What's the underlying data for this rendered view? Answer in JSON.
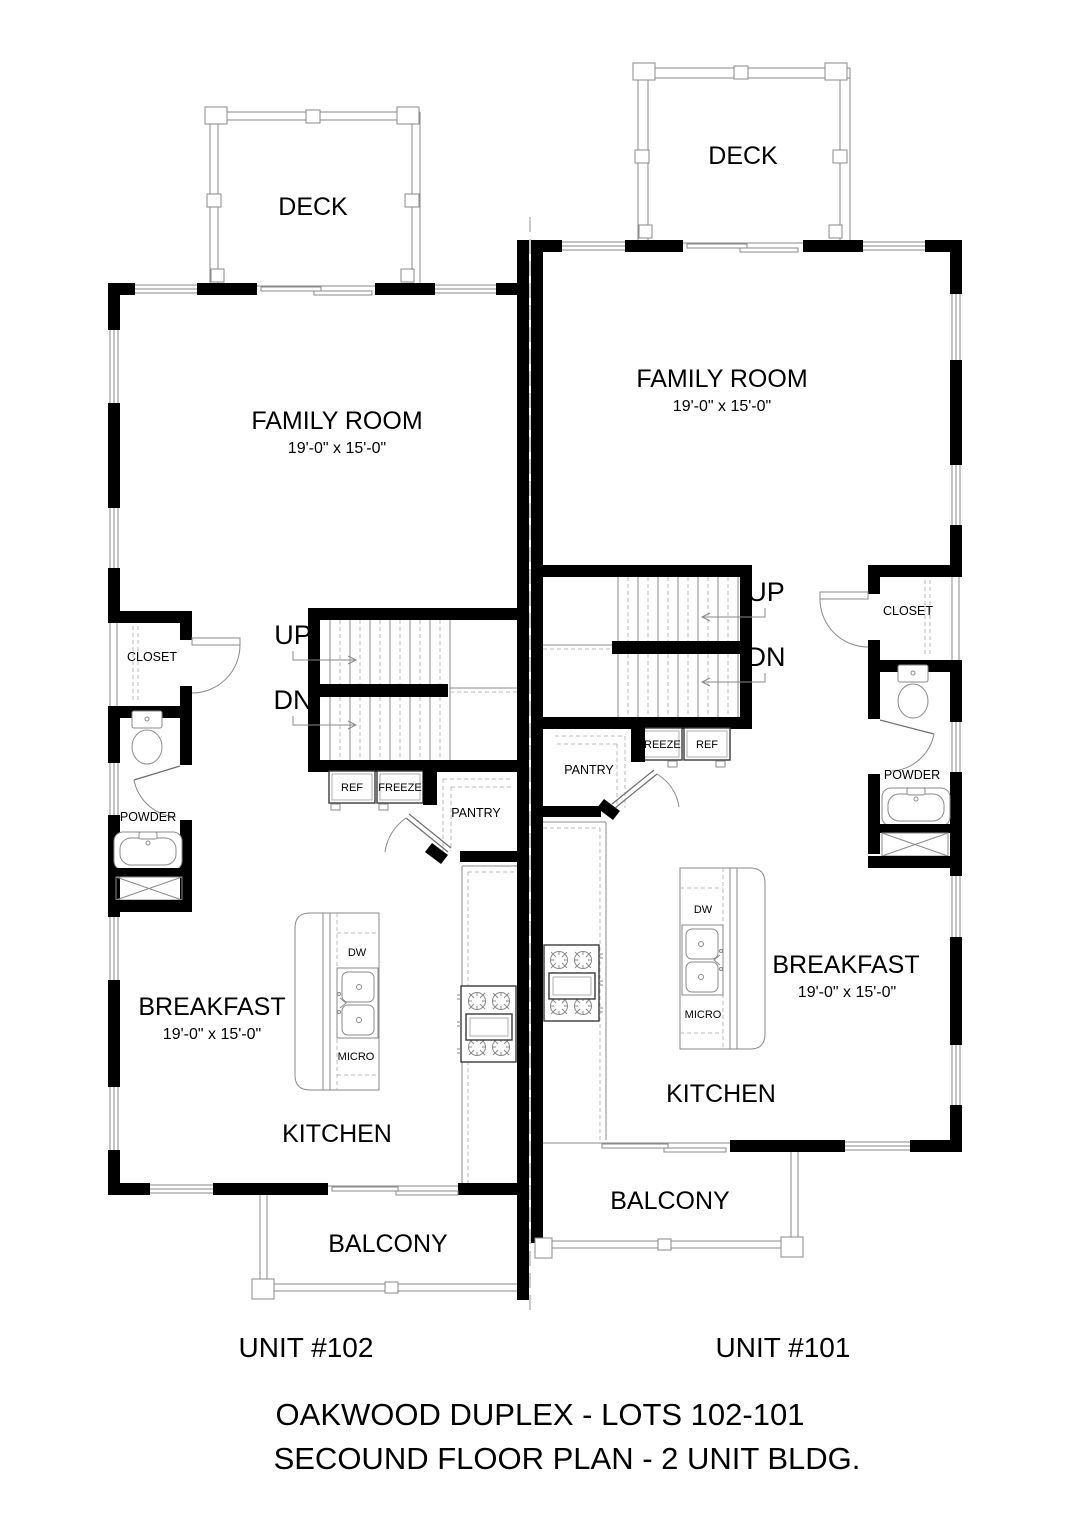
{
  "title": {
    "line1": "OAKWOOD DUPLEX - LOTS 102-101",
    "line2": "SECOUND FLOOR PLAN - 2 UNIT BLDG."
  },
  "unit_102": {
    "label": "UNIT #102",
    "deck": "DECK",
    "family_room": "FAMILY ROOM",
    "family_room_dims": "19'-0\" x 15'-0\"",
    "closet": "CLOSET",
    "powder": "POWDER",
    "up": "UP",
    "dn": "DN",
    "ref": "REF",
    "freeze": "FREEZE",
    "pantry": "PANTRY",
    "dw": "DW",
    "micro": "MICRO",
    "breakfast": "BREAKFAST",
    "breakfast_dims": "19'-0\" x 15'-0\"",
    "kitchen": "KITCHEN",
    "balcony": "BALCONY"
  },
  "unit_101": {
    "label": "UNIT #101",
    "deck": "DECK",
    "family_room": "FAMILY ROOM",
    "family_room_dims": "19'-0\" x 15'-0\"",
    "closet": "CLOSET",
    "powder": "POWDER",
    "up": "UP",
    "dn": "DN",
    "ref": "REF",
    "freeze": "FREEZE",
    "pantry": "PANTRY",
    "dw": "DW",
    "micro": "MICRO",
    "breakfast": "BREAKFAST",
    "breakfast_dims": "19'-0\" x 15'-0\"",
    "kitchen": "KITCHEN",
    "balcony": "BALCONY"
  },
  "colors": {
    "wall": "#000000",
    "thin_line": "#8a8a8a",
    "background": "#ffffff"
  }
}
